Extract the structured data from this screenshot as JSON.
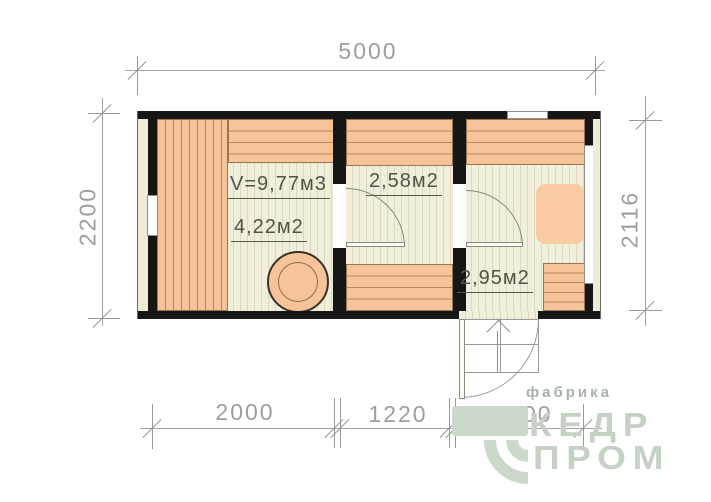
{
  "dimensions": {
    "top": "5000",
    "left": "2200",
    "right": "2116",
    "bottom": [
      "2000",
      "1220",
      "1400"
    ]
  },
  "rooms": {
    "sauna": {
      "volume_label": "V=9,77м3",
      "area_label": "4,22м2"
    },
    "washroom": {
      "area_label": "2,58м2"
    },
    "hall": {
      "area_label": "2,95м2"
    }
  },
  "watermark": {
    "tagline": "фабрика",
    "brand_top": "КЕДР",
    "brand_bottom": "ПРОМ"
  },
  "colors": {
    "wall": "#161616",
    "bench_fill": "#f6c498",
    "bench_line": "#b5895d",
    "floor_fill": "#f1eedb",
    "floor_line": "#dcd9c0",
    "cladding": "#efecd5",
    "dimension_text": "#9e9e9e",
    "room_text": "#55524a",
    "logo_green": "#c6d1c6",
    "logo_gray": "#a9b1ae"
  }
}
